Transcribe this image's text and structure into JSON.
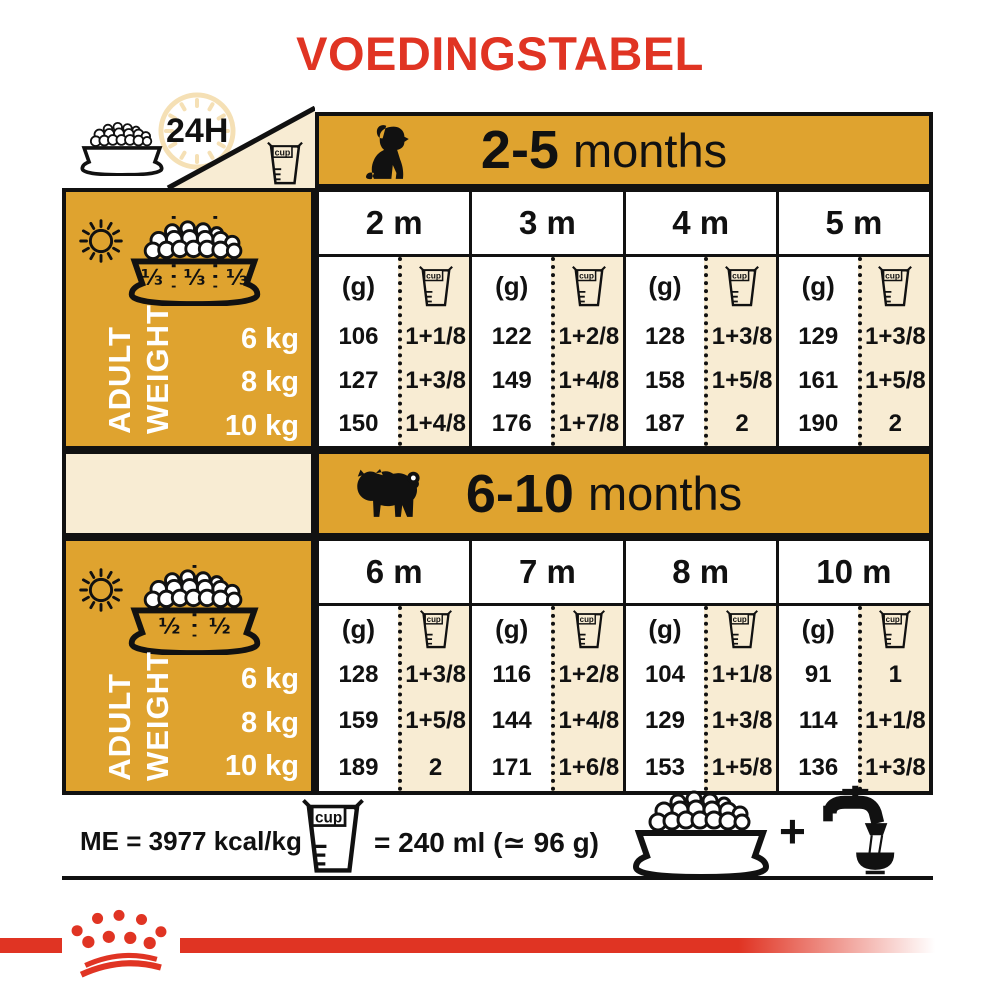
{
  "title": "VOEDINGSTABEL",
  "header_icons": {
    "hours": "24H"
  },
  "units": {
    "g": "(g)",
    "cup": "cup"
  },
  "adult_weight": {
    "line1": "ADULT",
    "line2": "WEIGHT"
  },
  "sections": [
    {
      "range": "2-5",
      "unit": "months",
      "bowl_fractions": [
        "⅓",
        "⅓",
        "⅓"
      ],
      "months": [
        "2 m",
        "3 m",
        "4 m",
        "5 m"
      ],
      "weights": [
        "6 kg",
        "8 kg",
        "10 kg"
      ],
      "grams": [
        [
          "106",
          "122",
          "128",
          "129"
        ],
        [
          "127",
          "149",
          "158",
          "161"
        ],
        [
          "150",
          "176",
          "187",
          "190"
        ]
      ],
      "cups": [
        [
          "1+1/8",
          "1+2/8",
          "1+3/8",
          "1+3/8"
        ],
        [
          "1+3/8",
          "1+4/8",
          "1+5/8",
          "1+5/8"
        ],
        [
          "1+4/8",
          "1+7/8",
          "2",
          "2"
        ]
      ]
    },
    {
      "range": "6-10",
      "unit": "months",
      "bowl_fractions": [
        "½",
        "½"
      ],
      "months": [
        "6 m",
        "7 m",
        "8 m",
        "10 m"
      ],
      "weights": [
        "6 kg",
        "8 kg",
        "10 kg"
      ],
      "grams": [
        [
          "128",
          "116",
          "104",
          "91"
        ],
        [
          "159",
          "144",
          "129",
          "114"
        ],
        [
          "189",
          "171",
          "153",
          "136"
        ]
      ],
      "cups": [
        [
          "1+3/8",
          "1+2/8",
          "1+1/8",
          "1"
        ],
        [
          "1+5/8",
          "1+4/8",
          "1+3/8",
          "1+1/8"
        ],
        [
          "2",
          "1+6/8",
          "1+5/8",
          "1+3/8"
        ]
      ]
    }
  ],
  "footer": {
    "me": "ME = 3977 kcal/kg",
    "cup_equiv": "= 240 ml (≃ 96 g)",
    "plus": "+"
  },
  "colors": {
    "red": "#E03423",
    "gold": "#DFA32F",
    "cream": "#F8ECD3",
    "black": "#111111",
    "clock": "#F5E0B5"
  }
}
